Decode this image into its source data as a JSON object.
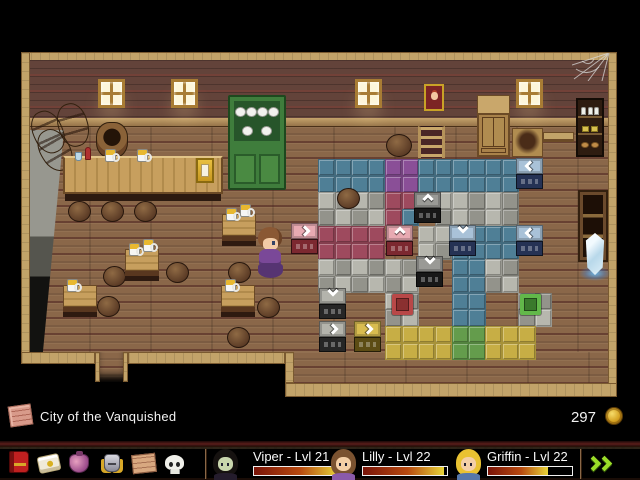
{
  "hud": {
    "location": {
      "icon": "map-scroll-icon",
      "label": "City of the Vanquished"
    },
    "gold": {
      "amount": "297",
      "icon": "gold-coin-icon"
    },
    "menu_icons": [
      {
        "name": "journal-icon"
      },
      {
        "name": "scroll-icon"
      },
      {
        "name": "items-bag-icon"
      },
      {
        "name": "equipment-icon"
      },
      {
        "name": "map-icon"
      },
      {
        "name": "skull-icon"
      }
    ],
    "party": [
      {
        "name": "Viper - Lvl 21",
        "hp_percent": 100,
        "hair": "#161210",
        "face": "#c9d6ad",
        "body": "#241c2c"
      },
      {
        "name": "Lilly - Lvl 22",
        "hp_percent": 97,
        "hair": "#7a5230",
        "face": "#f4cfa6",
        "body": "#8a5aaa"
      },
      {
        "name": "Griffin - Lvl 22",
        "hp_percent": 72,
        "hair": "#e9c232",
        "face": "#f4cfa6",
        "body": "#5577aa"
      }
    ],
    "hp_gradient": [
      "#7a1408",
      "#b84a10",
      "#e8d438"
    ],
    "next_button": "next-party-button"
  },
  "map": {
    "puzzle": {
      "x": 318,
      "y": 159,
      "tile": 16.7,
      "legend": {
        "B": {
          "n": "blue",
          "c": "#4f7f96"
        },
        "P": {
          "n": "purple",
          "c": "#8a4f97"
        },
        "R": {
          "n": "crimson",
          "c": "#9e4a5e"
        },
        "G": {
          "n": "stone-light",
          "c": "#b7b7ae"
        },
        "g": {
          "n": "stone-dark",
          "c": "#93938b"
        },
        "Y": {
          "n": "yellow",
          "c": "#c7ae45"
        },
        "N": {
          "n": "green",
          "c": "#649c4c"
        }
      },
      "rows": [
        "BBBBPPBBBBBB..",
        "BBBBPPBBBBBB..",
        "GgGgRR.GGgGg..",
        "gGgGRB.gGgGg..",
        "RRRR..GGBBBB..",
        "RRRR..GgBBBB..",
        "GgGgGg..BBGg..",
        "gGgGgG..BBgG..",
        "....Gg..BB..Gg",
        "....gG..BB..gG",
        "....YYYYNNYYY.",
        "....YYYYNNYYY."
      ]
    },
    "crates": [
      {
        "x": 516,
        "y": 158,
        "dir": "left",
        "kind": "blue",
        "top": "#a9c2d8",
        "body": "#253254"
      },
      {
        "x": 414,
        "y": 192,
        "dir": "up",
        "kind": "black",
        "top": "#9a9a96",
        "body": "#181818"
      },
      {
        "x": 386,
        "y": 225,
        "dir": "up",
        "kind": "pink",
        "top": "#e8aab2",
        "body": "#7c2830"
      },
      {
        "x": 449,
        "y": 225,
        "dir": "down",
        "kind": "blue",
        "top": "#a9c2d8",
        "body": "#253254"
      },
      {
        "x": 516,
        "y": 225,
        "dir": "left",
        "kind": "blue",
        "top": "#a9c2d8",
        "body": "#253254"
      },
      {
        "x": 416,
        "y": 256,
        "dir": "down",
        "kind": "black",
        "top": "#9a9a96",
        "body": "#181818"
      },
      {
        "x": 319,
        "y": 288,
        "dir": "down",
        "kind": "gray",
        "top": "#b4b4ac",
        "body": "#262626"
      },
      {
        "x": 319,
        "y": 321,
        "dir": "right",
        "kind": "gray",
        "top": "#b4b4ac",
        "body": "#262626"
      },
      {
        "x": 354,
        "y": 321,
        "dir": "right",
        "kind": "gold",
        "top": "#d8bc50",
        "body": "#5c4c14"
      },
      {
        "x": 291,
        "y": 223,
        "dir": "right",
        "kind": "pink",
        "top": "#e8aab2",
        "body": "#7c2830"
      }
    ],
    "buttons": [
      {
        "x": 392,
        "y": 294,
        "kind": "red",
        "border": "#b84848",
        "fill": "#8a3030"
      },
      {
        "x": 520,
        "y": 294,
        "kind": "green",
        "border": "#62b84a",
        "fill": "#3a7a2c"
      }
    ],
    "furniture": [
      {
        "type": "window",
        "x": 98,
        "y": 79
      },
      {
        "type": "window",
        "x": 171,
        "y": 79
      },
      {
        "type": "window",
        "x": 355,
        "y": 79
      },
      {
        "type": "window",
        "x": 516,
        "y": 79
      },
      {
        "type": "portrait",
        "x": 424,
        "y": 84
      },
      {
        "type": "spiderweb",
        "x": 572,
        "y": 53
      },
      {
        "type": "green-hutch",
        "x": 228,
        "y": 95
      },
      {
        "type": "barrel-tilt",
        "x": 33,
        "y": 110,
        "r": -24
      },
      {
        "type": "barrel-tilt",
        "x": 58,
        "y": 103,
        "r": -16
      },
      {
        "type": "barrel-tilt",
        "x": 40,
        "y": 128,
        "r": -30
      },
      {
        "type": "barrel-open",
        "x": 96,
        "y": 122
      },
      {
        "type": "counter",
        "x": 63,
        "y": 156
      },
      {
        "type": "wardrobe",
        "x": 477,
        "y": 95
      },
      {
        "type": "ladder",
        "x": 418,
        "y": 126
      },
      {
        "type": "bench",
        "x": 543,
        "y": 132
      },
      {
        "type": "broken-table",
        "x": 512,
        "y": 128
      },
      {
        "type": "jar-shelf",
        "x": 576,
        "y": 98
      },
      {
        "type": "bookshelf",
        "x": 578,
        "y": 190
      },
      {
        "type": "crystal",
        "x": 583,
        "y": 233
      },
      {
        "type": "round-table",
        "x": 386,
        "y": 134
      },
      {
        "type": "stool",
        "x": 68,
        "y": 201
      },
      {
        "type": "stool",
        "x": 101,
        "y": 201
      },
      {
        "type": "stool",
        "x": 134,
        "y": 201
      },
      {
        "type": "stool",
        "x": 103,
        "y": 266
      },
      {
        "type": "stool",
        "x": 166,
        "y": 262
      },
      {
        "type": "stool",
        "x": 228,
        "y": 262
      },
      {
        "type": "stool",
        "x": 97,
        "y": 296
      },
      {
        "type": "stool",
        "x": 257,
        "y": 297
      },
      {
        "type": "stool",
        "x": 227,
        "y": 327
      },
      {
        "type": "stool",
        "x": 337,
        "y": 188
      },
      {
        "type": "table",
        "x": 125,
        "y": 249,
        "mugs": 2
      },
      {
        "type": "table",
        "x": 63,
        "y": 285,
        "mugs": 1
      },
      {
        "type": "table",
        "x": 222,
        "y": 214,
        "mugs": 2
      },
      {
        "type": "table",
        "x": 221,
        "y": 285,
        "mugs": 1
      },
      {
        "type": "player",
        "x": 255,
        "y": 227
      }
    ]
  }
}
